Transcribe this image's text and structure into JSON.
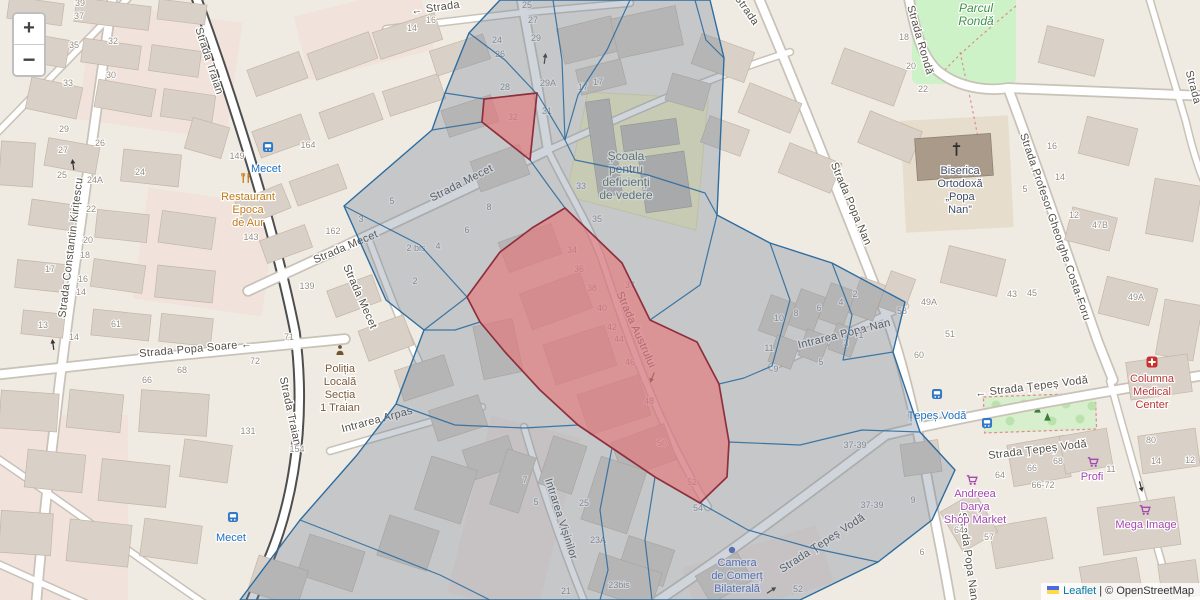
{
  "controls": {
    "zoom_in": "+",
    "zoom_out": "−"
  },
  "attribution": {
    "leaflet": "Leaflet",
    "sep": " | ",
    "osm": "© OpenStreetMap"
  },
  "map": {
    "street_labels": [
      {
        "text": "Strada Traian",
        "x": 206,
        "y": 62,
        "rot": 72
      },
      {
        "text": "Strada Traian",
        "x": 287,
        "y": 412,
        "rot": 78
      },
      {
        "text": "Strada Constantin Kirițescu",
        "x": 74,
        "y": 248,
        "rot": -83
      },
      {
        "text": "Strada Popa Soare ←",
        "x": 196,
        "y": 352,
        "rot": -5
      },
      {
        "text": "Strada Mecet",
        "x": 347,
        "y": 250,
        "rot": -23
      },
      {
        "text": "Strada Mecet",
        "x": 357,
        "y": 298,
        "rot": 66
      },
      {
        "text": "Strada Mecet",
        "x": 463,
        "y": 186,
        "rot": -27
      },
      {
        "text": "← Strada",
        "x": 436,
        "y": 11,
        "rot": -8
      },
      {
        "text": "Strada",
        "x": 744,
        "y": 12,
        "rot": 55
      },
      {
        "text": "Strada Austrului",
        "x": 633,
        "y": 331,
        "rot": 66
      },
      {
        "text": "Intrarea Arpas",
        "x": 378,
        "y": 423,
        "rot": -15
      },
      {
        "text": "Intrarea Vișinilor",
        "x": 558,
        "y": 520,
        "rot": 72
      },
      {
        "text": "Intrarea Popa Nan",
        "x": 845,
        "y": 337,
        "rot": -14
      },
      {
        "text": "Strada Popa Nan",
        "x": 848,
        "y": 205,
        "rot": 67
      },
      {
        "text": "Strada Popa Nan",
        "x": 965,
        "y": 557,
        "rot": 82
      },
      {
        "text": "Strada Rondă",
        "x": 917,
        "y": 41,
        "rot": 74
      },
      {
        "text": "Strada Profesor Gheorghe Costa-Foru",
        "x": 1052,
        "y": 228,
        "rot": 71
      },
      {
        "text": "Strada",
        "x": 1190,
        "y": 88,
        "rot": 75
      },
      {
        "text": "← Strada Țepeș Vodă",
        "x": 1032,
        "y": 390,
        "rot": -7
      },
      {
        "text": "Strada Țepeș Vodă",
        "x": 1038,
        "y": 453,
        "rot": -7
      },
      {
        "text": "Strada Țepeș Vodă",
        "x": 824,
        "y": 546,
        "rot": -33
      }
    ],
    "house_numbers": [
      [
        "39",
        80,
        6
      ],
      [
        "37",
        79,
        19
      ],
      [
        "35",
        74,
        48
      ],
      [
        "33",
        68,
        86
      ],
      [
        "32",
        113,
        44
      ],
      [
        "30",
        111,
        78
      ],
      [
        "29",
        64,
        132
      ],
      [
        "27",
        63,
        153
      ],
      [
        "26",
        100,
        146
      ],
      [
        "25",
        62,
        178
      ],
      [
        "24A",
        95,
        183
      ],
      [
        "24",
        140,
        175
      ],
      [
        "22",
        91,
        212
      ],
      [
        "20",
        88,
        243
      ],
      [
        "18",
        85,
        258
      ],
      [
        "17",
        50,
        272
      ],
      [
        "16",
        83,
        282
      ],
      [
        "14",
        81,
        295
      ],
      [
        "13",
        43,
        328
      ],
      [
        "61",
        116,
        327
      ],
      [
        "14",
        74,
        340
      ],
      [
        "149",
        237,
        159
      ],
      [
        "164",
        308,
        148
      ],
      [
        "143",
        251,
        240
      ],
      [
        "162",
        333,
        234
      ],
      [
        "139",
        307,
        289
      ],
      [
        "71",
        289,
        340
      ],
      [
        "72",
        255,
        364
      ],
      [
        "68",
        182,
        373
      ],
      [
        "66",
        147,
        383
      ],
      [
        "131",
        248,
        434
      ],
      [
        "154",
        297,
        452
      ],
      [
        "3",
        361,
        222
      ],
      [
        "5",
        392,
        204
      ],
      [
        "2 bis",
        416,
        251
      ],
      [
        "4",
        438,
        249
      ],
      [
        "6",
        467,
        233
      ],
      [
        "8",
        489,
        210
      ],
      [
        "2",
        415,
        284
      ],
      [
        "14",
        412,
        31
      ],
      [
        "16",
        431,
        23
      ],
      [
        "24",
        497,
        43
      ],
      [
        "26",
        500,
        57
      ],
      [
        "25",
        527,
        8
      ],
      [
        "27",
        533,
        23
      ],
      [
        "29",
        536,
        41
      ],
      [
        "28",
        505,
        90
      ],
      [
        "29A",
        548,
        86
      ],
      [
        "31",
        547,
        114
      ],
      [
        "32",
        513,
        120
      ],
      [
        "17",
        583,
        90
      ],
      [
        "17",
        598,
        85
      ],
      [
        "33",
        581,
        189
      ],
      [
        "35",
        597,
        222
      ],
      [
        "37",
        630,
        288
      ],
      [
        "34",
        572,
        253
      ],
      [
        "36",
        579,
        272
      ],
      [
        "38",
        592,
        291
      ],
      [
        "40",
        602,
        311
      ],
      [
        "42",
        612,
        330
      ],
      [
        "44",
        619,
        342
      ],
      [
        "46",
        630,
        365
      ],
      [
        "48",
        649,
        404
      ],
      [
        "50",
        662,
        446
      ],
      [
        "52",
        692,
        485
      ],
      [
        "54",
        698,
        511
      ],
      [
        "7",
        525,
        483
      ],
      [
        "5",
        536,
        505
      ],
      [
        "25",
        584,
        506
      ],
      [
        "23A",
        598,
        543
      ],
      [
        "23bis",
        619,
        588
      ],
      [
        "21",
        566,
        594
      ],
      [
        "2",
        855,
        297
      ],
      [
        "4",
        841,
        305
      ],
      [
        "6",
        819,
        311
      ],
      [
        "8",
        796,
        316
      ],
      [
        "10",
        779,
        321
      ],
      [
        "11",
        769,
        351
      ],
      [
        "9",
        776,
        372
      ],
      [
        "1",
        861,
        338
      ],
      [
        "3",
        846,
        346
      ],
      [
        "5",
        821,
        365
      ],
      [
        "49A",
        929,
        305
      ],
      [
        "58",
        902,
        314
      ],
      [
        "51",
        950,
        337
      ],
      [
        "60",
        919,
        358
      ],
      [
        "47B",
        1100,
        228
      ],
      [
        "16",
        1052,
        149
      ],
      [
        "14",
        1060,
        180
      ],
      [
        "12",
        1074,
        218
      ],
      [
        "5",
        1025,
        192
      ],
      [
        "43",
        1012,
        297
      ],
      [
        "45",
        1032,
        296
      ],
      [
        "49A",
        1136,
        300
      ],
      [
        "18",
        904,
        40
      ],
      [
        "20",
        911,
        69
      ],
      [
        "22",
        923,
        92
      ],
      [
        "80",
        1151,
        443
      ],
      [
        "14",
        1156,
        464
      ],
      [
        "12",
        1190,
        463
      ],
      [
        "64",
        1000,
        478
      ],
      [
        "66",
        1032,
        471
      ],
      [
        "68",
        1058,
        464
      ],
      [
        "66-72",
        1043,
        488
      ],
      [
        "11",
        1111,
        472
      ],
      [
        "64",
        959,
        533
      ],
      [
        "57",
        989,
        540
      ],
      [
        "37-39",
        855,
        448
      ],
      [
        "37-39",
        872,
        508
      ],
      [
        "9",
        913,
        503
      ],
      [
        "6",
        922,
        555
      ],
      [
        "52",
        798,
        592
      ]
    ],
    "pois": [
      {
        "lines": [
          "Restaurant",
          "Epoca",
          "de Aur"
        ],
        "x": 248,
        "y": 200,
        "cls": "poi-food",
        "icon": "cutlery-icon",
        "ix": 246,
        "iy": 178
      },
      {
        "lines": [
          "Poliția",
          "Locală",
          "Secția",
          "1 Traian"
        ],
        "x": 340,
        "y": 372,
        "cls": "poi-police",
        "icon": "police-icon",
        "ix": 340,
        "iy": 350
      },
      {
        "lines": [
          "Școala",
          "pentru",
          "deficienți",
          "de vedere"
        ],
        "x": 626,
        "y": 160,
        "cls": "poi-school"
      },
      {
        "lines": [
          "Biserica",
          "Ortodoxă",
          "„Popa",
          "Nan”"
        ],
        "x": 960,
        "y": 174,
        "cls": "poi-church"
      },
      {
        "lines": [
          "Columna",
          "Medical",
          "Center"
        ],
        "x": 1152,
        "y": 382,
        "cls": "poi-health",
        "icon": "hospital-icon",
        "ix": 1152,
        "iy": 362
      },
      {
        "lines": [
          "Camera",
          "de Comerț",
          "Bilaterală"
        ],
        "x": 737,
        "y": 566,
        "cls": "poi-office",
        "icon": "dot-icon",
        "ix": 732,
        "iy": 550
      },
      {
        "lines": [
          "Profi"
        ],
        "x": 1092,
        "y": 480,
        "cls": "poi-shop",
        "icon": "cart-icon",
        "ix": 1093,
        "iy": 462
      },
      {
        "lines": [
          "Andreea",
          "Darya",
          "Shop Market"
        ],
        "x": 975,
        "y": 497,
        "cls": "poi-shop",
        "icon": "cart-icon",
        "ix": 972,
        "iy": 480
      },
      {
        "lines": [
          "Mega Image"
        ],
        "x": 1146,
        "y": 528,
        "cls": "poi-shop",
        "icon": "cart-icon",
        "ix": 1145,
        "iy": 510
      },
      {
        "lines": [
          "Parcul",
          "Rondă"
        ],
        "x": 976,
        "y": 12,
        "cls": "poi-park"
      }
    ],
    "transit_stops": [
      {
        "label": "Mecet",
        "x": 266,
        "y": 163,
        "icon_x": 268,
        "icon_y": 147
      },
      {
        "label": "Mecet",
        "x": 231,
        "y": 532,
        "icon_x": 233,
        "icon_y": 517
      },
      {
        "label": "Țepeș Vodă",
        "x": 937,
        "y": 410,
        "icon_x": 937,
        "icon_y": 394
      }
    ],
    "extra_bus_icons": [
      {
        "x": 987,
        "y": 423
      }
    ],
    "one_way_arrows": [
      {
        "x": 545,
        "y": 58,
        "rot": -82
      },
      {
        "x": 73,
        "y": 164,
        "rot": -98
      },
      {
        "x": 53,
        "y": 344,
        "rot": -98
      },
      {
        "x": 652,
        "y": 378,
        "rot": 112
      },
      {
        "x": 772,
        "y": 590,
        "rot": -33
      },
      {
        "x": 1141,
        "y": 487,
        "rot": 75
      }
    ],
    "overlay": {
      "stroke": "#2d6da0",
      "fill": "rgba(112,128,150,0.33)",
      "red_stroke": "#8e2f3e",
      "red_fill": "rgba(233,114,117,0.6)",
      "outer": [
        [
          500,
          0
        ],
        [
          710,
          0
        ],
        [
          724,
          58
        ],
        [
          717,
          215
        ],
        [
          770,
          243
        ],
        [
          832,
          263
        ],
        [
          905,
          302
        ],
        [
          893,
          352
        ],
        [
          920,
          432
        ],
        [
          955,
          470
        ],
        [
          932,
          520
        ],
        [
          878,
          562
        ],
        [
          800,
          600
        ],
        [
          240,
          600
        ],
        [
          300,
          520
        ],
        [
          357,
          455
        ],
        [
          396,
          404
        ],
        [
          424,
          330
        ],
        [
          386,
          300
        ],
        [
          344,
          206
        ],
        [
          432,
          130
        ],
        [
          445,
          93
        ],
        [
          469,
          33
        ]
      ],
      "edges": [
        [
          [
            553,
            0
          ],
          [
            562,
            60
          ],
          [
            565,
            140
          ]
        ],
        [
          [
            630,
            0
          ],
          [
            607,
            50
          ],
          [
            578,
            95
          ],
          [
            565,
            140
          ]
        ],
        [
          [
            695,
            0
          ],
          [
            706,
            40
          ],
          [
            724,
            58
          ]
        ],
        [
          [
            565,
            140
          ],
          [
            575,
            160
          ],
          [
            648,
            175
          ],
          [
            705,
            193
          ],
          [
            717,
            215
          ]
        ],
        [
          [
            565,
            140
          ],
          [
            537,
            93
          ]
        ],
        [
          [
            469,
            33
          ],
          [
            505,
            60
          ],
          [
            536,
            93
          ]
        ],
        [
          [
            445,
            93
          ],
          [
            484,
            99
          ]
        ],
        [
          [
            482,
            122
          ],
          [
            432,
            130
          ]
        ],
        [
          [
            530,
            160
          ],
          [
            548,
            185
          ],
          [
            565,
            208
          ]
        ],
        [
          [
            344,
            206
          ],
          [
            420,
            245
          ],
          [
            467,
            297
          ]
        ],
        [
          [
            424,
            330
          ],
          [
            467,
            297
          ]
        ],
        [
          [
            424,
            330
          ],
          [
            455,
            330
          ],
          [
            480,
            322
          ]
        ],
        [
          [
            396,
            404
          ],
          [
            455,
            425
          ],
          [
            524,
            428
          ],
          [
            578,
            425
          ]
        ],
        [
          [
            300,
            520
          ],
          [
            372,
            548
          ],
          [
            440,
            575
          ],
          [
            490,
            600
          ]
        ],
        [
          [
            650,
            320
          ],
          [
            700,
            285
          ],
          [
            717,
            215
          ]
        ],
        [
          [
            770,
            243
          ],
          [
            790,
            300
          ],
          [
            772,
            366
          ],
          [
            744,
            378
          ],
          [
            719,
            384
          ]
        ],
        [
          [
            832,
            263
          ],
          [
            852,
            315
          ],
          [
            843,
            360
          ],
          [
            893,
            352
          ]
        ],
        [
          [
            729,
            442
          ],
          [
            800,
            445
          ],
          [
            862,
            430
          ],
          [
            920,
            432
          ]
        ],
        [
          [
            700,
            503
          ],
          [
            748,
            530
          ],
          [
            812,
            548
          ],
          [
            878,
            562
          ]
        ],
        [
          [
            655,
            477
          ],
          [
            645,
            540
          ],
          [
            652,
            600
          ]
        ],
        [
          [
            612,
            448
          ],
          [
            600,
            510
          ],
          [
            608,
            570
          ],
          [
            600,
            600
          ]
        ]
      ],
      "red_polygons": [
        [
          [
            484,
            99
          ],
          [
            537,
            93
          ],
          [
            530,
            160
          ],
          [
            482,
            122
          ]
        ],
        [
          [
            565,
            208
          ],
          [
            622,
            263
          ],
          [
            650,
            320
          ],
          [
            697,
            342
          ],
          [
            719,
            384
          ],
          [
            729,
            442
          ],
          [
            727,
            477
          ],
          [
            700,
            503
          ],
          [
            655,
            477
          ],
          [
            612,
            448
          ],
          [
            578,
            425
          ],
          [
            540,
            390
          ],
          [
            505,
            352
          ],
          [
            480,
            322
          ],
          [
            467,
            297
          ],
          [
            500,
            252
          ],
          [
            532,
            228
          ]
        ]
      ]
    }
  }
}
